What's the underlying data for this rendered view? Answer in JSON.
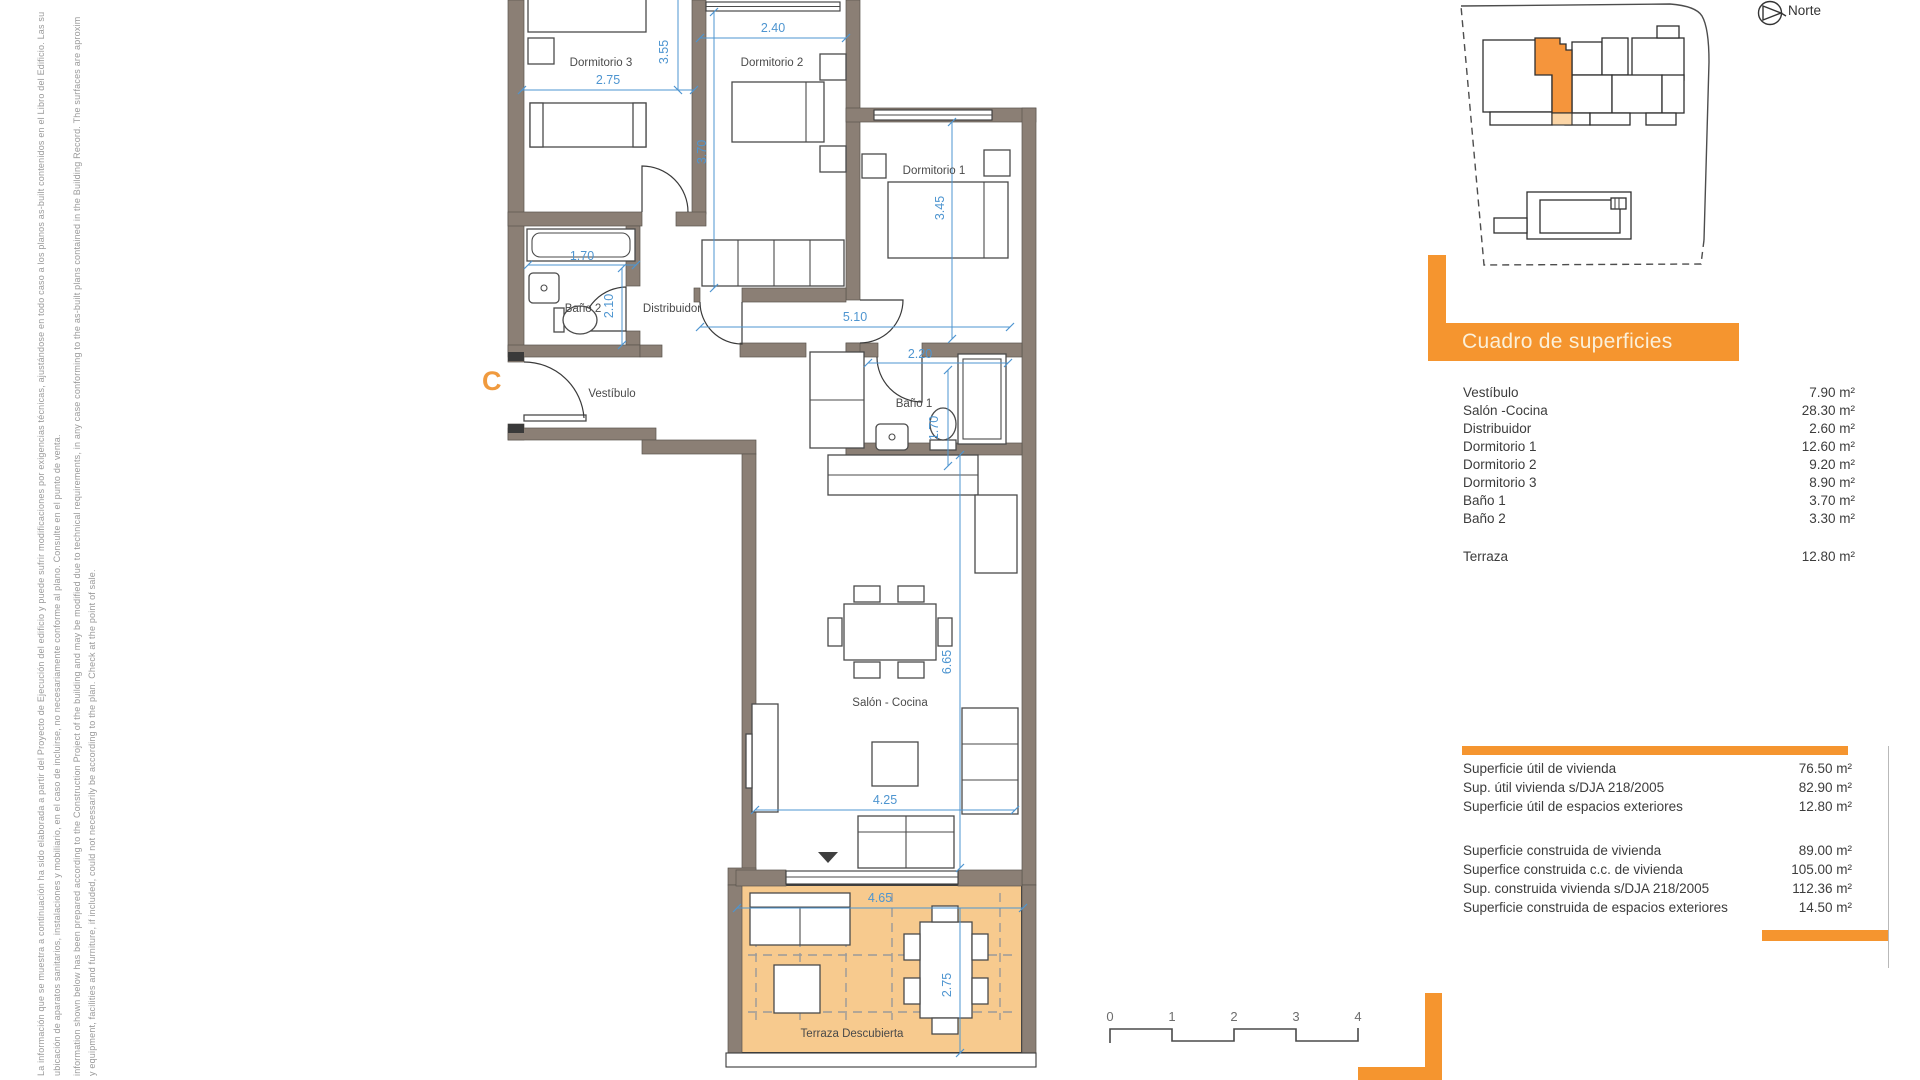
{
  "disclaimer": {
    "lines": [
      "La información que se muestra a continuación ha sido elaborada a partir del Proyecto de Ejecución del edificio y puede sufrir modificaciones por exigencias técnicas, ajustándose en todo caso a los planos as-built contenidos en el Libro del Edificio. Las su",
      "ubicación de aparatos sanitarios, instalaciones y mobiliario, en el caso de incluirse, no necesariamente conforme al plano. Consulte en el punto de venta.",
      "information shown below has been prepared according to the Construction Project of the building and may be modified due to technical requirements, in any case conforming to the as-built plans contained in the Building Record. The surfaces are aproxim",
      "y equipment, facilities and furniture, if included, could not necessarily be according to the plan. Check at the point of sale."
    ]
  },
  "north": {
    "label": "Norte"
  },
  "plan": {
    "unit_letter": "C",
    "rooms": {
      "dorm3": "Dormitorio 3",
      "dorm2": "Dormitorio 2",
      "dorm1": "Dormitorio 1",
      "bano2": "Baño 2",
      "bano1": "Baño 1",
      "distribuidor": "Distribuidor",
      "vestibulo": "Vestíbulo",
      "salon": "Salón - Cocina",
      "terraza": "Terraza Descubierta"
    },
    "dims": {
      "d275": "2.75",
      "d355": "3.55",
      "d240": "2.40",
      "d370": "3.70",
      "d345": "3.45",
      "d170a": "1.70",
      "d210": "2.10",
      "d510": "5.10",
      "d220": "2.20",
      "d170b": "1.70",
      "d665": "6.65",
      "d425": "4.25",
      "d465": "4.65",
      "d275b": "2.75"
    }
  },
  "surfaces": {
    "title": "Cuadro de superficies",
    "rows": [
      {
        "label": "Vestíbulo",
        "value": "7.90 m²"
      },
      {
        "label": "Salón -Cocina",
        "value": "28.30 m²"
      },
      {
        "label": "Distribuidor",
        "value": "2.60 m²"
      },
      {
        "label": "Dormitorio 1",
        "value": "12.60 m²"
      },
      {
        "label": "Dormitorio 2",
        "value": "9.20 m²"
      },
      {
        "label": "Dormitorio 3",
        "value": "8.90 m²"
      },
      {
        "label": "Baño 1",
        "value": "3.70 m²"
      },
      {
        "label": "Baño 2",
        "value": "3.30 m²"
      }
    ],
    "terraza_row": {
      "label": "Terraza",
      "value": "12.80 m²"
    }
  },
  "totals": {
    "util": [
      {
        "label": "Superficie útil de vivienda",
        "value": "76.50 m²"
      },
      {
        "label": "Sup. útil vivienda s/DJA 218/2005",
        "value": "82.90 m²"
      },
      {
        "label": "Superficie útil de espacios exteriores",
        "value": "12.80 m²"
      }
    ],
    "construida": [
      {
        "label": "Superficie construida de vivienda",
        "value": "89.00 m²"
      },
      {
        "label": "Superfice construida c.c. de vivienda",
        "value": "105.00 m²"
      },
      {
        "label": "Sup. construida vivienda s/DJA 218/2005",
        "value": "112.36 m²"
      },
      {
        "label": "Superficie construida de espacios exteriores",
        "value": "14.50 m²"
      }
    ]
  },
  "scalebar": {
    "ticks": [
      "0",
      "1",
      "2",
      "3",
      "4"
    ]
  },
  "colors": {
    "accent": "#F5952F",
    "terrace": "#F7CA8E",
    "wall": "#8B7F75",
    "dimension": "#4E95D0"
  }
}
